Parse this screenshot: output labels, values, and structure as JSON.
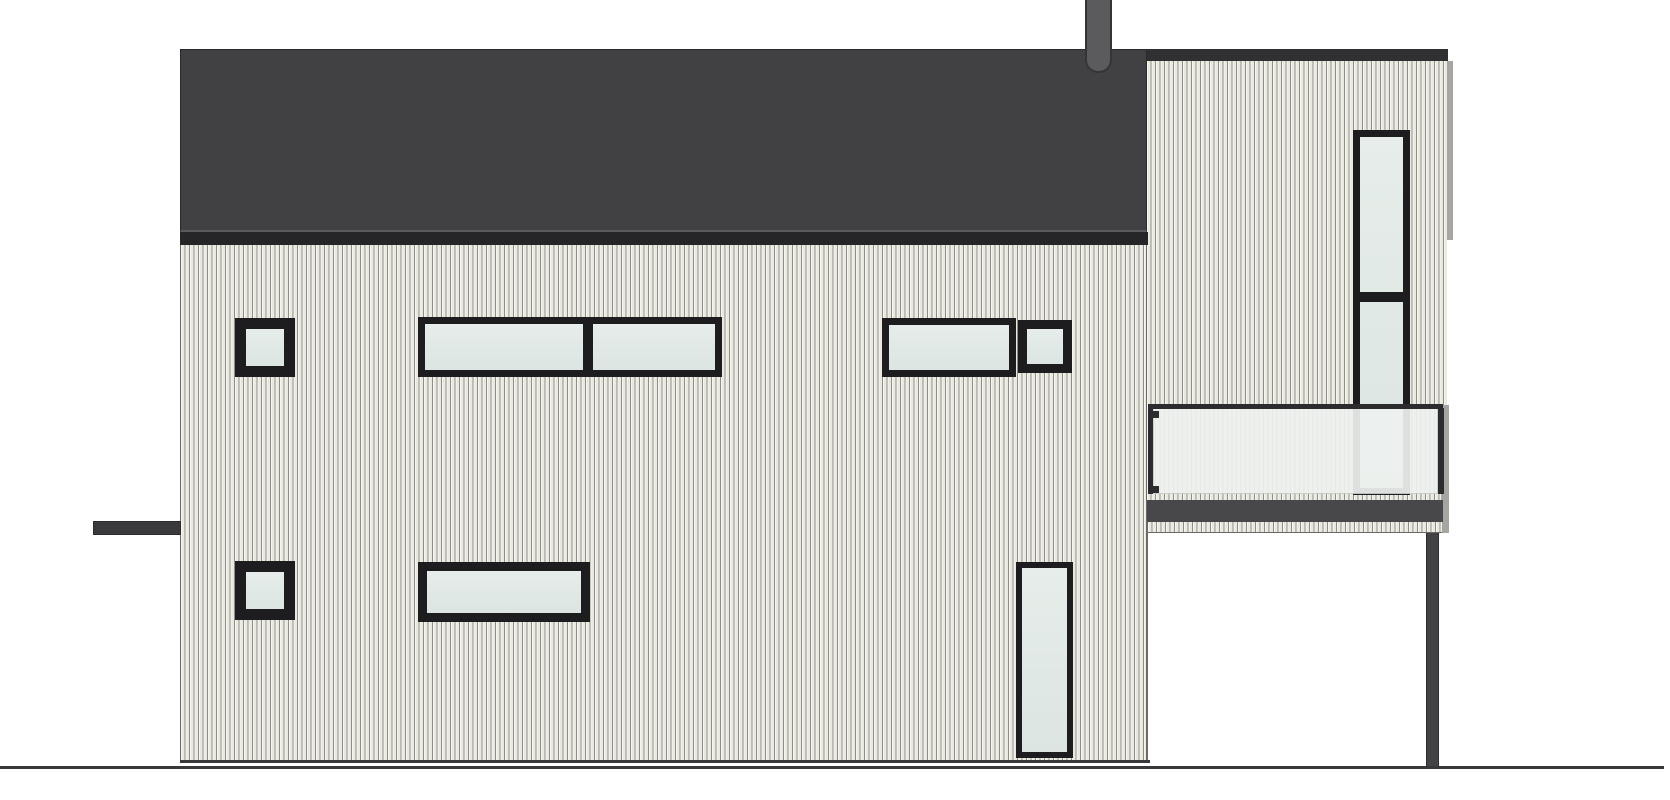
{
  "drawing": {
    "name": "house-side-elevation",
    "kind": "architectural-elevation"
  },
  "canvas": {
    "width": 1670,
    "height": 800,
    "background": "#ffffff"
  },
  "colors": {
    "background": "#ffffff",
    "roof": "#414143",
    "roof_outline": "#2a2a2c",
    "roof_fascia": "#262628",
    "roof_fascia_gap": "#5a5a5d",
    "tower_roof_band": "#303033",
    "chimney": "#5b5b5d",
    "chimney_outline": "#353537",
    "siding_board": "#eae9e1",
    "siding_highlight": "#f6f5ef",
    "siding_groove": "#8f8e86",
    "siding_edge": "#6b6a64",
    "corner_strip": "#a6a5a1",
    "window_frame": "#1d1d1f",
    "glass_light": "#e6edea",
    "glass": "#dce5e2",
    "balcony_glass": "#eef1ef",
    "rail": "#2c2c2e",
    "slab": "#48484a",
    "post": "#434345",
    "ground": "#38383a",
    "awning_bar": "#3a3a3d"
  },
  "layout": {
    "facade_siding": {
      "x": 180,
      "y": 245,
      "w": 968,
      "h": 515
    },
    "facade_edge_line": {
      "x": 1146,
      "y": 245,
      "w": 2,
      "h": 515
    },
    "tower_siding": {
      "x": 1147,
      "y": 61,
      "w": 300,
      "h": 440
    },
    "tower_corner_strip": {
      "x": 1447,
      "y": 61,
      "w": 6,
      "h": 179
    },
    "roof_body": {
      "x": 180,
      "y": 49,
      "w": 967,
      "h": 183
    },
    "roof_fascia": {
      "x": 180,
      "y": 232,
      "w": 968,
      "h": 13
    },
    "tower_roof_band": {
      "x": 1147,
      "y": 49,
      "w": 301,
      "h": 12
    },
    "chimney": {
      "x": 1085,
      "y": 0,
      "w": 27,
      "h": 73
    },
    "balcony_side_strip": {
      "x": 1441,
      "y": 405,
      "w": 8,
      "h": 128
    },
    "balcony_rail": {
      "x": 1148,
      "y": 404,
      "w": 295,
      "h": 5
    },
    "balcony_glass_left_post": {
      "x": 1148,
      "y": 408,
      "w": 5,
      "h": 86
    },
    "balcony_glass": {
      "x": 1153,
      "y": 408,
      "w": 285,
      "h": 86
    },
    "balcony_glass_right_post": {
      "x": 1438,
      "y": 408,
      "w": 6,
      "h": 86
    },
    "balcony_clip_top": {
      "x": 1153,
      "y": 411,
      "w": 6,
      "h": 7
    },
    "balcony_clip_bottom": {
      "x": 1153,
      "y": 486,
      "w": 6,
      "h": 7
    },
    "balcony_slab": {
      "x": 1147,
      "y": 500,
      "w": 296,
      "h": 22
    },
    "balcony_soffit": {
      "x": 1148,
      "y": 522,
      "w": 294,
      "h": 11
    },
    "support_post": {
      "x": 1426,
      "y": 533,
      "w": 13,
      "h": 235
    },
    "left_awning_bar": {
      "x": 93,
      "y": 521,
      "w": 88,
      "h": 14
    },
    "facade_base_line": {
      "x": 180,
      "y": 760,
      "w": 970,
      "h": 3
    },
    "ground_line": {
      "x": 0,
      "y": 766,
      "w": 1664,
      "h": 3
    }
  },
  "windows": [
    {
      "name": "window-upper-left-square",
      "x": 235,
      "y": 318,
      "w": 60,
      "h": 59,
      "frame": 11
    },
    {
      "name": "window-upper-band-left",
      "x": 418,
      "y": 317,
      "w": 304,
      "h": 60,
      "frame": 7,
      "vmullions": [
        {
          "x": 165,
          "w": 10
        }
      ]
    },
    {
      "name": "window-upper-band-right",
      "x": 882,
      "y": 318,
      "w": 134,
      "h": 59,
      "frame": 7
    },
    {
      "name": "window-upper-right-square",
      "x": 1018,
      "y": 320,
      "w": 54,
      "h": 53,
      "frame": 9
    },
    {
      "name": "window-lower-left-square",
      "x": 235,
      "y": 561,
      "w": 60,
      "h": 59,
      "frame": 11
    },
    {
      "name": "window-lower-band",
      "x": 418,
      "y": 562,
      "w": 172,
      "h": 60,
      "frame": 9
    },
    {
      "name": "window-tall-lower",
      "x": 1016,
      "y": 562,
      "w": 57,
      "h": 196,
      "frame": 6
    },
    {
      "name": "window-tower-tall",
      "x": 1353,
      "y": 130,
      "w": 57,
      "h": 365,
      "frame": 7,
      "hmullions": [
        {
          "y": 162,
          "h": 10
        }
      ]
    }
  ]
}
